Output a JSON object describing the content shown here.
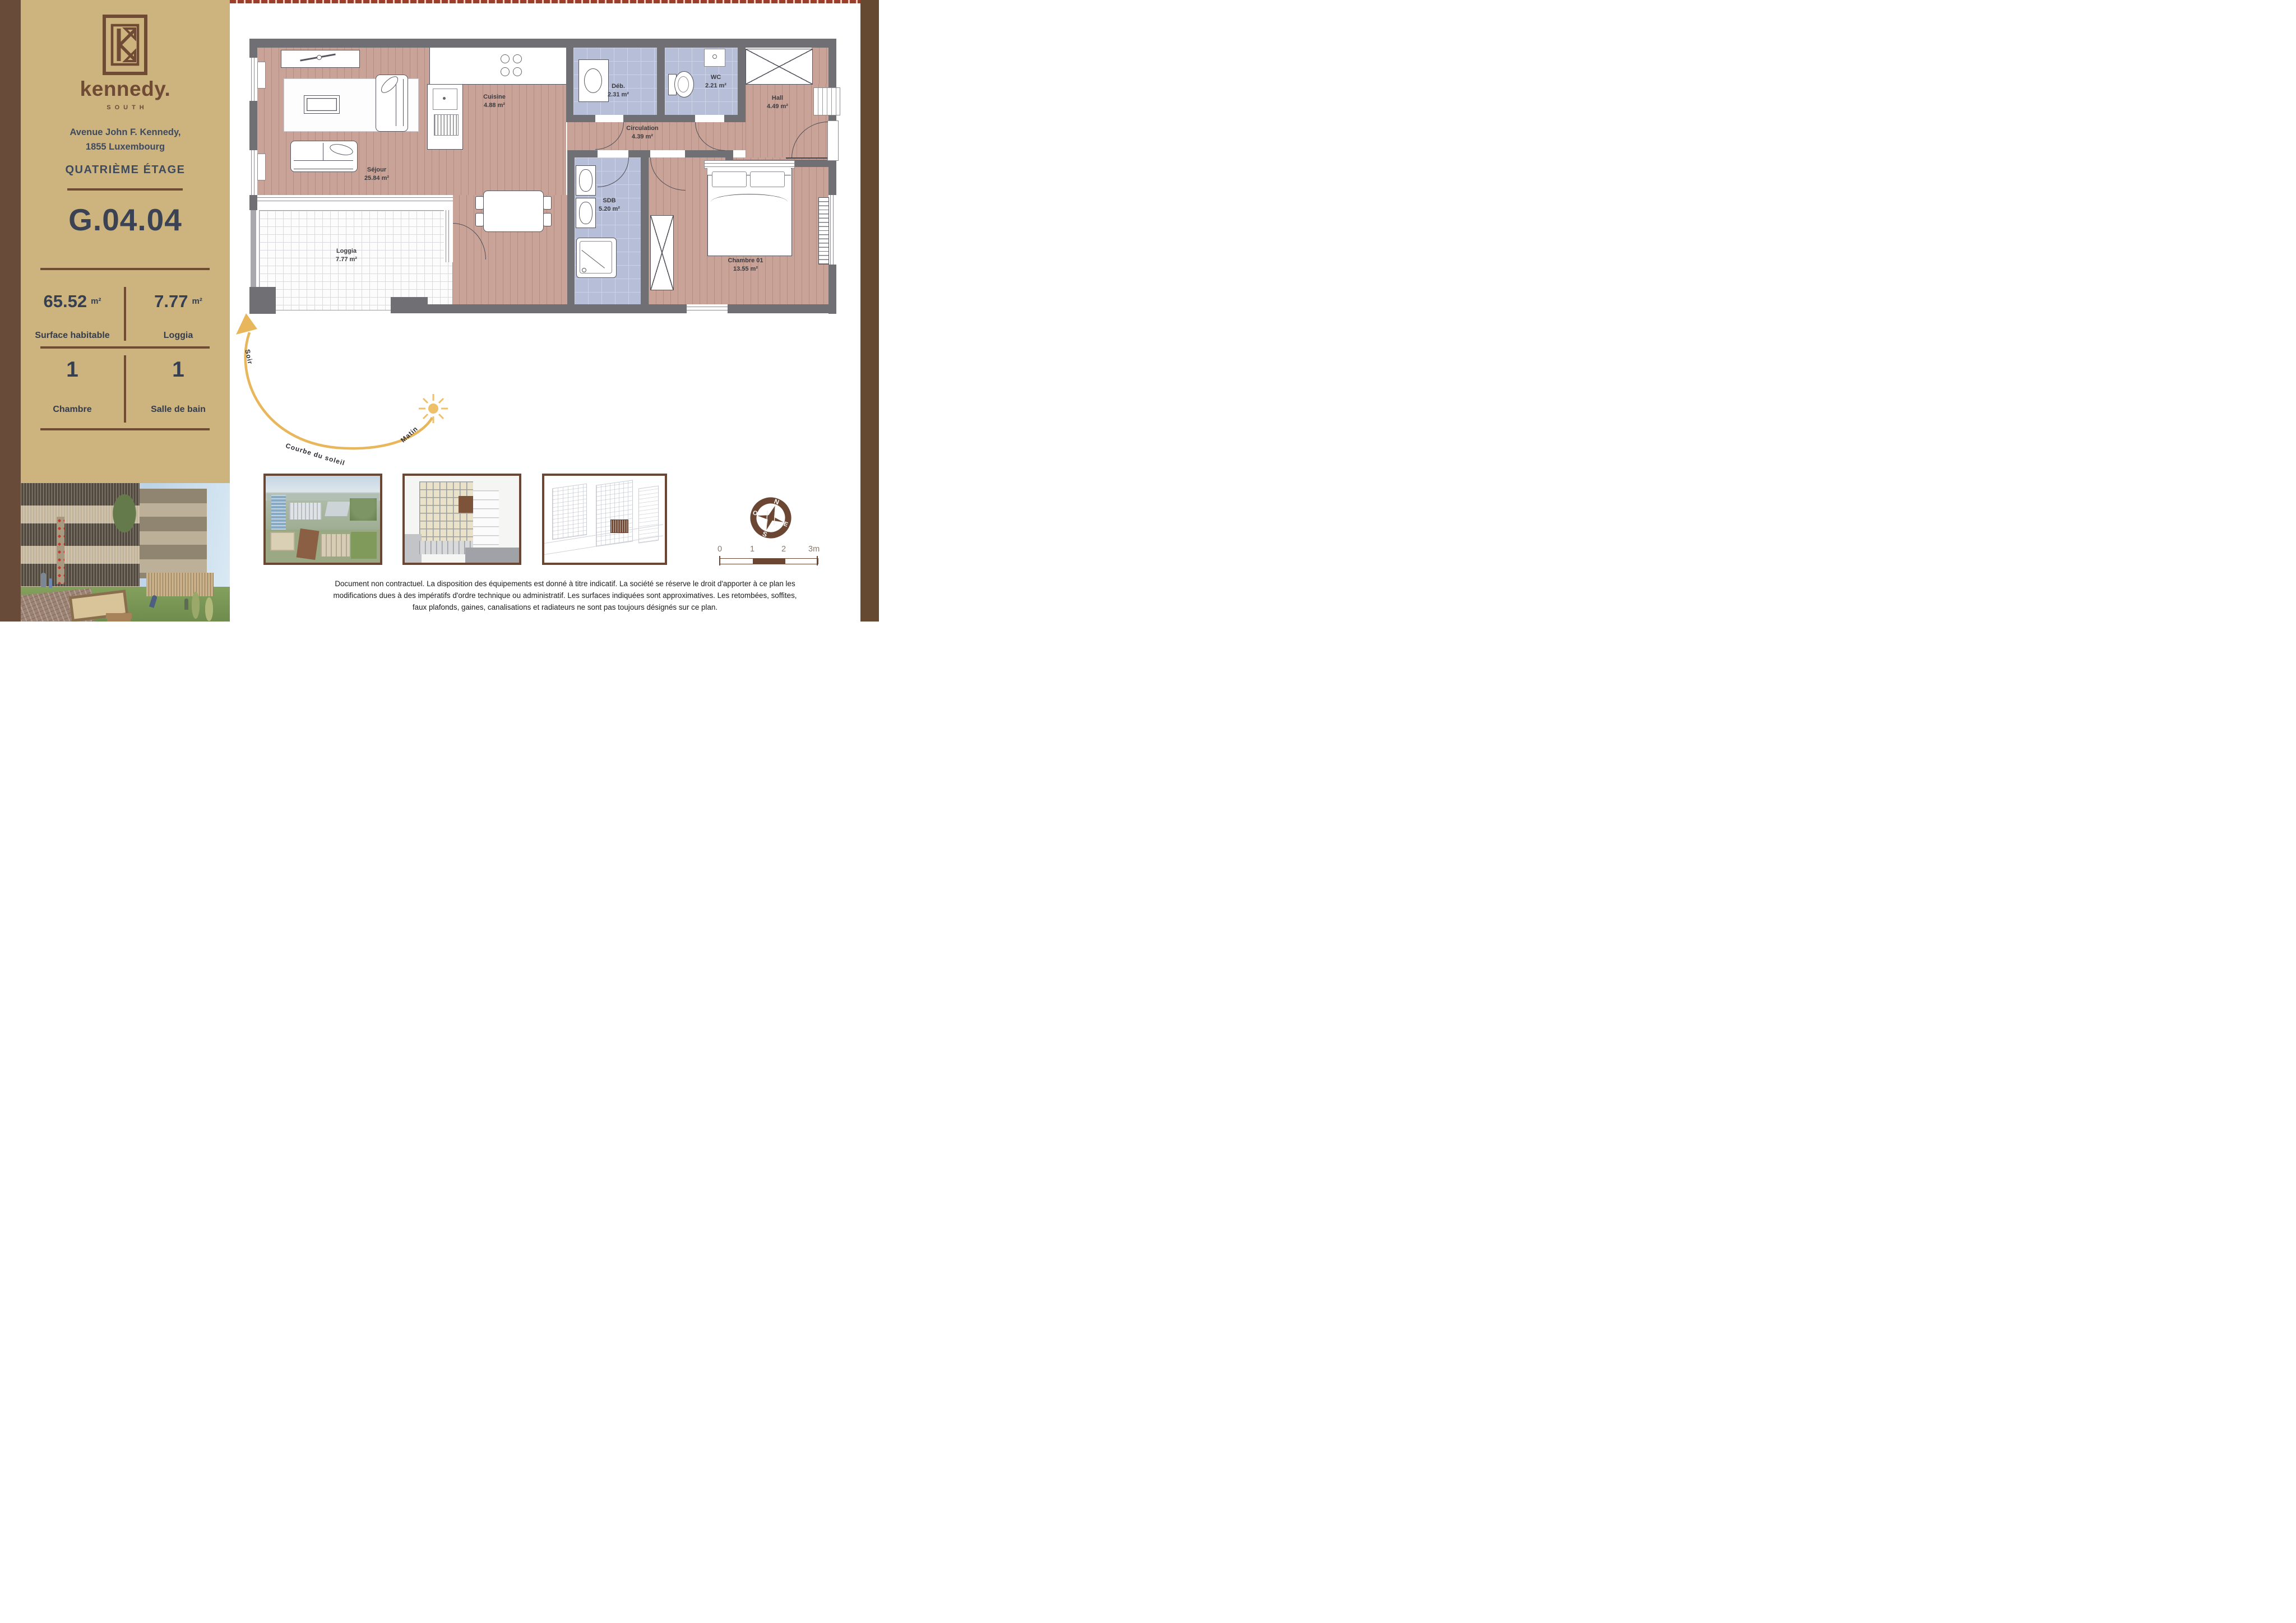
{
  "sidebar": {
    "brand": {
      "name": "kennedy.",
      "sub": "SOUTH"
    },
    "address_line1": "Avenue John F. Kennedy,",
    "address_line2": "1855 Luxembourg",
    "floor": "QUATRIÈME ÉTAGE",
    "unit": "G.04.04",
    "stats": [
      {
        "value": "65.52",
        "unit": "m²",
        "label": "Surface habitable"
      },
      {
        "value": "7.77",
        "unit": "m²",
        "label": "Loggia"
      },
      {
        "value": "1",
        "label": "Chambre"
      },
      {
        "value": "1",
        "label": "Salle de bain"
      }
    ]
  },
  "plan": {
    "rooms": [
      {
        "name": "Séjour",
        "area": "25.84 m²"
      },
      {
        "name": "Cuisine",
        "area": "4.88 m²"
      },
      {
        "name": "Déb.",
        "area": "2.31 m²"
      },
      {
        "name": "WC",
        "area": "2.21 m²"
      },
      {
        "name": "Hall",
        "area": "4.49 m²"
      },
      {
        "name": "Circulation",
        "area": "4.39 m²"
      },
      {
        "name": "SDB",
        "area": "5.20 m²"
      },
      {
        "name": "Chambre 01",
        "area": "13.55 m²"
      },
      {
        "name": "Loggia",
        "area": "7.77 m²"
      }
    ]
  },
  "sun": {
    "evening": "Soir",
    "morning": "Matin",
    "curve": "Courbe du soleil"
  },
  "compass": {
    "n": "N",
    "e": "E",
    "s": "S",
    "o": "O"
  },
  "scale": {
    "ticks": [
      "0",
      "1",
      "2",
      "3m"
    ]
  },
  "disclaimer": {
    "lines": [
      "Document non contractuel. La disposition des équipements est donné à titre indicatif. La société se réserve le droit d'apporter à ce plan les",
      "modifications dues à des impératifs d'ordre technique ou administratif. Les surfaces indiquées sont approximatives. Les retombées, soffites,",
      "faux plafonds, gaines, canalisations et radiateurs ne sont pas toujours désignés sur ce plan."
    ]
  },
  "colors": {
    "sidebar_tan": "#cdb37d",
    "brown_dark": "#684c39",
    "brand_brown": "#6f4a34",
    "text_slate": "#3a4254",
    "wall_gray": "#6f6f74",
    "floor_rose": "#c9a397",
    "tile_lavender": "#b7bed8",
    "sun_amber": "#e8b75c",
    "accent_brick": "#9a3f2c"
  }
}
